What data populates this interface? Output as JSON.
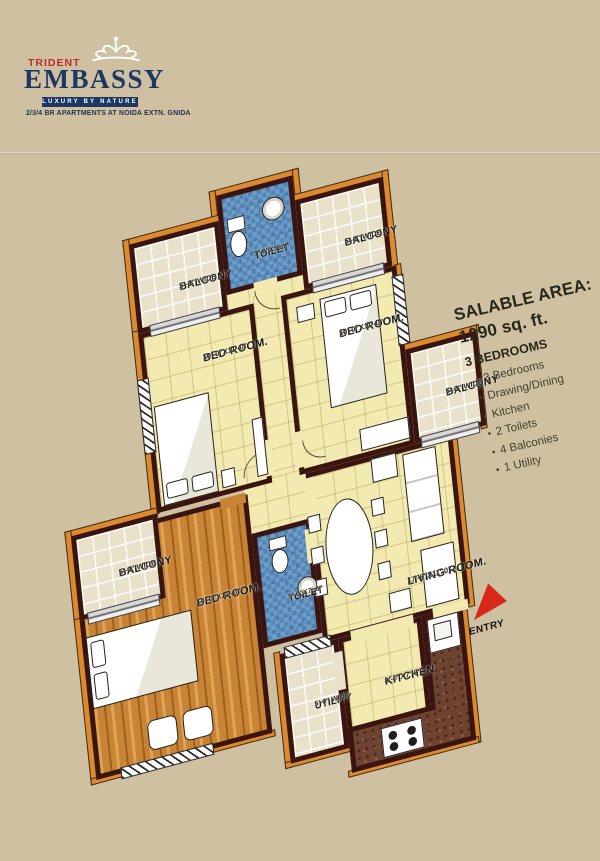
{
  "brand": {
    "trident": "TRIDENT",
    "name": "EMBASSY",
    "tagline": "LUXURY BY NATURE",
    "subtitle": "2/3/4 BR APARTMENTS AT NOIDA EXTN. GNIDA"
  },
  "info": {
    "title": "SALABLE AREA:",
    "area": "1290 sq. ft.",
    "heading": "3 BEDROOMS",
    "bullet": "•",
    "items": [
      "3 Bedrooms",
      "Drawing/Dining",
      "Kitchen",
      "2 Toilets",
      "4 Balconies",
      "1 Utility"
    ]
  },
  "rooms": {
    "toilet_top": {
      "name": "TOILET",
      "dim": "7'-6\"X5'-0\""
    },
    "balcony_top_left": {
      "name": "BALCONY",
      "dim": "5'-0\" WIDE"
    },
    "balcony_top_right": {
      "name": "BALCONY",
      "dim": "5'-0\" WIDE"
    },
    "bedroom_1": {
      "name": "BED ROOM.",
      "dim": "10'-0\"X11'-0\""
    },
    "bedroom_2": {
      "name": "BED ROOM.",
      "dim": "10'-0\"X11'-0\""
    },
    "balcony_right": {
      "name": "BALCONY",
      "dim": "5'-0\" WIDE"
    },
    "balcony_left": {
      "name": "BALCONY",
      "dim": "5'-0\" WIDE"
    },
    "master_bedroom": {
      "name": "BED ROOM.",
      "dim": "14'-0\"X11'-0\""
    },
    "toilet_2": {
      "name": "TOILET",
      "dim": "5'-0\"X7'-6\""
    },
    "living_room": {
      "name": "LIVING ROOM.",
      "dim": "17'-6\"X11'-0\""
    },
    "kitchen": {
      "name": "KITCHEN",
      "dim": "8'-0\"X7'-6\""
    },
    "utility": {
      "name": "UTILITY",
      "dim": "5'-0\" WIDE"
    }
  },
  "entry_label": "ENTRY",
  "colors": {
    "background": "#cec0a0",
    "wall": "#3a150f",
    "outline_accent": "#dd8a2e",
    "floor_yellow": "#f3eab2",
    "balcony_tile": "#e9e1ca",
    "toilet_blue": "#5d92c3",
    "wood_floor": "#c98334",
    "kitchen_counter": "#6f4332",
    "entry_red": "#d8281a",
    "brand_red": "#bf2b2b",
    "brand_navy": "#1c3765"
  }
}
